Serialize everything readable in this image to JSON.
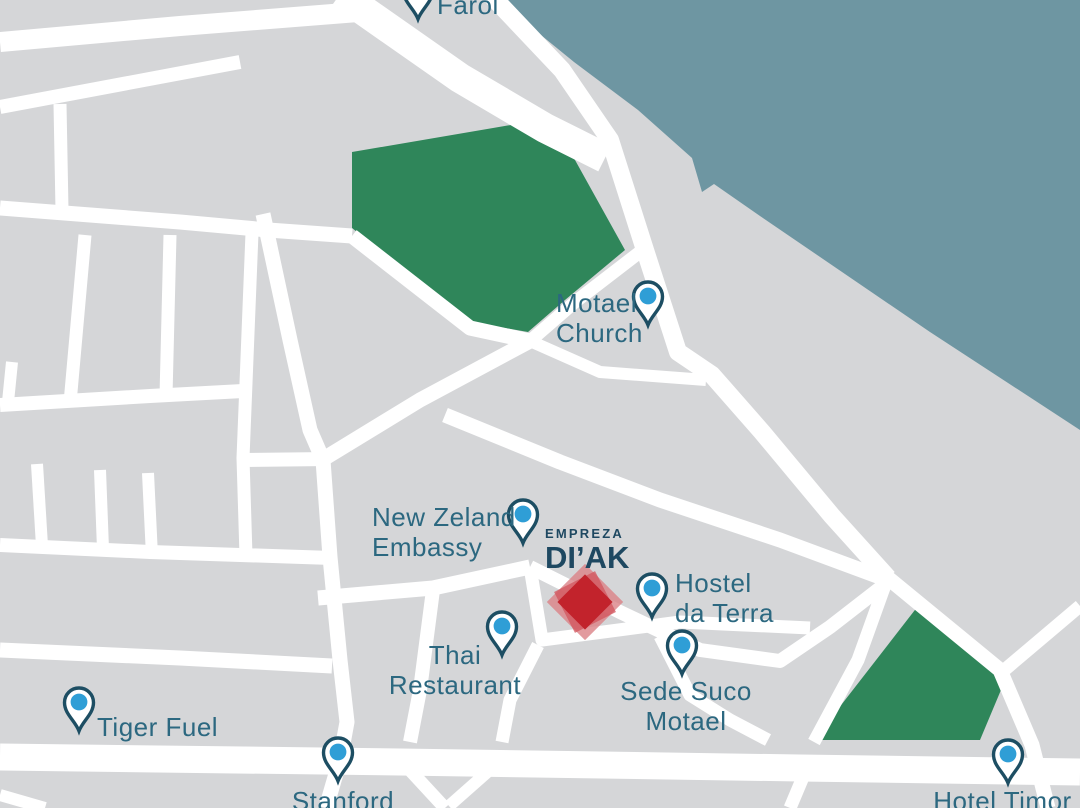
{
  "map": {
    "logo": {
      "prefix": "EMPREZA",
      "name": "DI’AK"
    },
    "places": {
      "farol": {
        "line1": "Farol",
        "line2": ""
      },
      "motael_church": {
        "line1": "Motael",
        "line2": "Church"
      },
      "new_zeland_embassy": {
        "line1": "New Zeland",
        "line2": "Embassy"
      },
      "hostel_da_terra": {
        "line1": "Hostel",
        "line2": "da Terra"
      },
      "thai_restaurant": {
        "line1": "Thai",
        "line2": "Restaurant"
      },
      "sede_suco_motael": {
        "line1": "Sede Suco",
        "line2": "Motael"
      },
      "tiger_fuel": {
        "line1": "Tiger Fuel",
        "line2": ""
      },
      "stanford": {
        "line1": "Stanford",
        "line2": ""
      },
      "hotel_timor": {
        "line1": "Hotel Timor",
        "line2": ""
      }
    },
    "colors": {
      "water": "#6e96a2",
      "land": "#d5d6d8",
      "road": "#ffffff",
      "park": "#2f865a",
      "label_text": "#2c6880",
      "logo_text": "#1e4861",
      "pin_outline": "#1d4e63",
      "pin_dot": "#2f9ed6",
      "marker_red_core": "#c2232c",
      "marker_red_light": "#db8287"
    }
  }
}
